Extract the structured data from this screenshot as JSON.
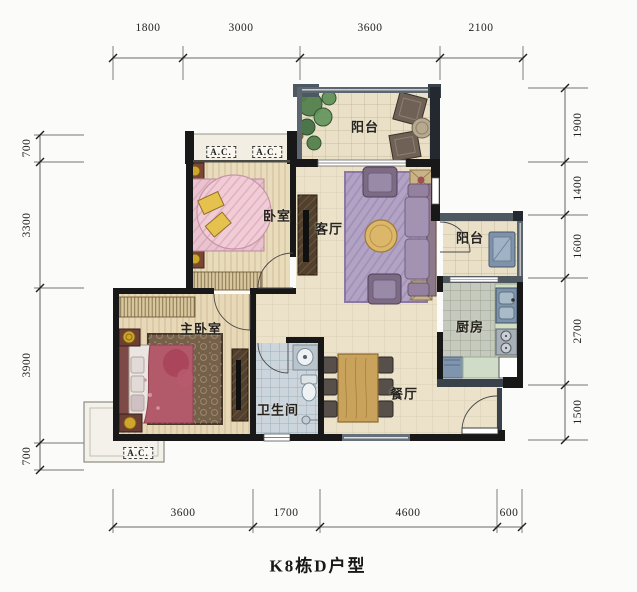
{
  "title": "K8栋D户型",
  "dims": {
    "top": [
      "1800",
      "3000",
      "3600",
      "2100"
    ],
    "bottom": [
      "3600",
      "1700",
      "4600",
      "600"
    ],
    "left": [
      "700",
      "3300",
      "3900",
      "700"
    ],
    "right": [
      "1900",
      "1400",
      "1600",
      "2700",
      "1500"
    ]
  },
  "rooms": {
    "balcony_top": "阳台",
    "bedroom": "卧室",
    "living_room": "客厅",
    "balcony_right": "阳台",
    "kitchen": "厨房",
    "master_bedroom": "主卧室",
    "bathroom": "卫生间",
    "dining_room": "餐厅"
  },
  "ac_units": {
    "top_left": "A.C.",
    "top_right": "A.C.",
    "bottom": "A.C."
  },
  "colors": {
    "wall_black": "#181818",
    "wall_grey": "#5c6670",
    "floor_beige": "#ece2ca",
    "floor_wood": "#e9dcbd",
    "bathroom_tile": "#ccd5dc",
    "kitchen_tile": "#c6cabe",
    "kitchen_counter": "#d3dec7",
    "appliance_blue": "#7e93aa",
    "rug_purple": "#b2a2c3",
    "bed_pink": "#e9c4d0",
    "master_bed_red": "#b2596a",
    "wood_table": "#c9a35c",
    "plant_green": "#4e7d49",
    "lamp_gold": "#cfa52c"
  }
}
